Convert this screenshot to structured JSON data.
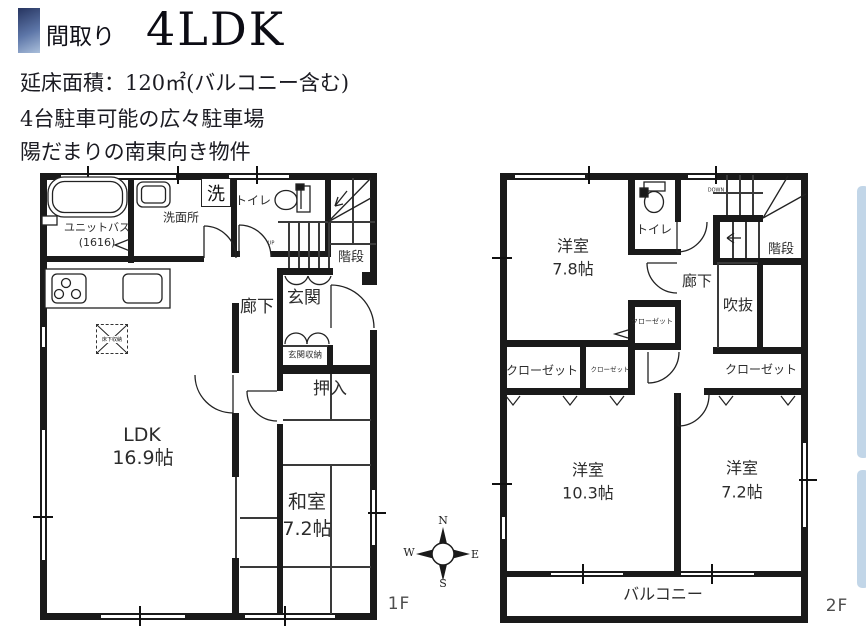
{
  "header": {
    "tag": "間取り",
    "type": "4LDK",
    "line1": "延床面積：120㎡(バルコニー含む)",
    "line2": "4台駐車可能の広々駐車場",
    "line3": "陽だまりの南東向き物件"
  },
  "f1": {
    "floor_label": "1F",
    "unit_bath_line1": "ユニットバス",
    "unit_bath_line2": "(1616)",
    "washroom": "洗面所",
    "laundry": "洗",
    "toilet": "トイレ",
    "stairs": "階段",
    "up": "UP",
    "corridor": "廊下",
    "entrance": "玄関",
    "entrance_storage": "玄関収納",
    "oshiire": "押入",
    "ldk_name": "LDK",
    "ldk_size": "16.9帖",
    "washitsu_name": "和室",
    "washitsu_size": "7.2帖",
    "floor_storage": "床下収納"
  },
  "f2": {
    "floor_label": "2F",
    "room1_name": "洋室",
    "room1_size": "7.8帖",
    "toilet": "トイレ",
    "down": "DOWN",
    "stairs": "階段",
    "corridor": "廊下",
    "void": "吹抜",
    "closet_mid": "クローゼット",
    "closet_big": "クローゼット",
    "closet_small": "クローゼット",
    "closet_right": "クローゼット",
    "room2_name": "洋室",
    "room2_size": "10.3帖",
    "room3_name": "洋室",
    "room3_size": "7.2帖",
    "balcony": "バルコニー"
  },
  "compass": {
    "n": "N",
    "e": "E",
    "w": "W",
    "s": "S"
  },
  "colors": {
    "wall": "#1a1a1a",
    "accent_top": "#2b3a66",
    "accent_bottom": "#aabfdb",
    "side_strip": "#c2d6e8"
  }
}
